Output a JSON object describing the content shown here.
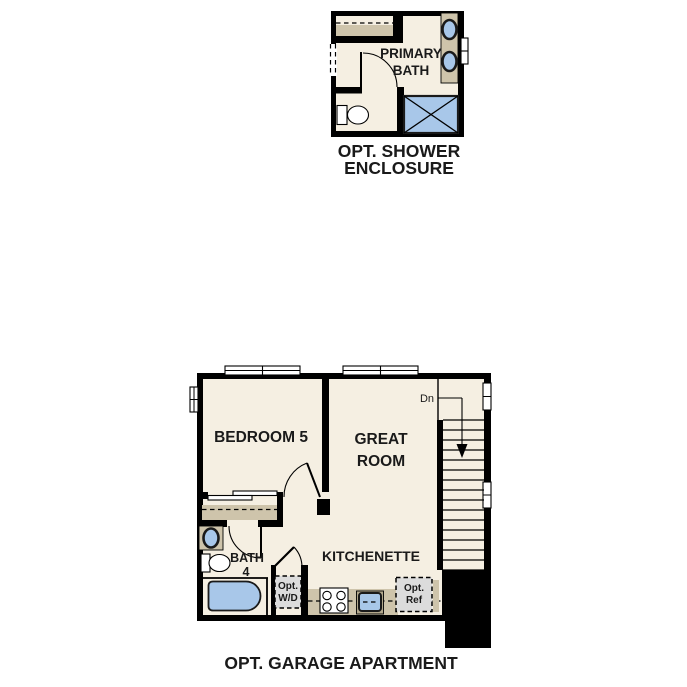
{
  "colors": {
    "wall": "#000000",
    "ink": "#1a1a1a",
    "floor": "#f5efe2",
    "cabinet": "#cec4ab",
    "cabinet_dark": "#b3a88c",
    "fixture": "#a8c7e9",
    "optbox": "#dcdcdc",
    "window": "#ffffff"
  },
  "shower_plan": {
    "room": {
      "line1": "PRIMARY",
      "line2": "BATH"
    },
    "caption": {
      "line1": "OPT. SHOWER",
      "line2": "ENCLOSURE"
    }
  },
  "apartment_plan": {
    "bedroom": "BEDROOM 5",
    "great_room": {
      "line1": "GREAT",
      "line2": "ROOM"
    },
    "kitchenette": "KITCHENETTE",
    "bath": {
      "line1": "BATH",
      "line2": "4"
    },
    "stairs": "Dn",
    "washer_dryer": {
      "line1": "Opt.",
      "line2": "W/D"
    },
    "fridge": {
      "line1": "Opt.",
      "line2": "Ref"
    },
    "caption": "OPT. GARAGE APARTMENT"
  }
}
